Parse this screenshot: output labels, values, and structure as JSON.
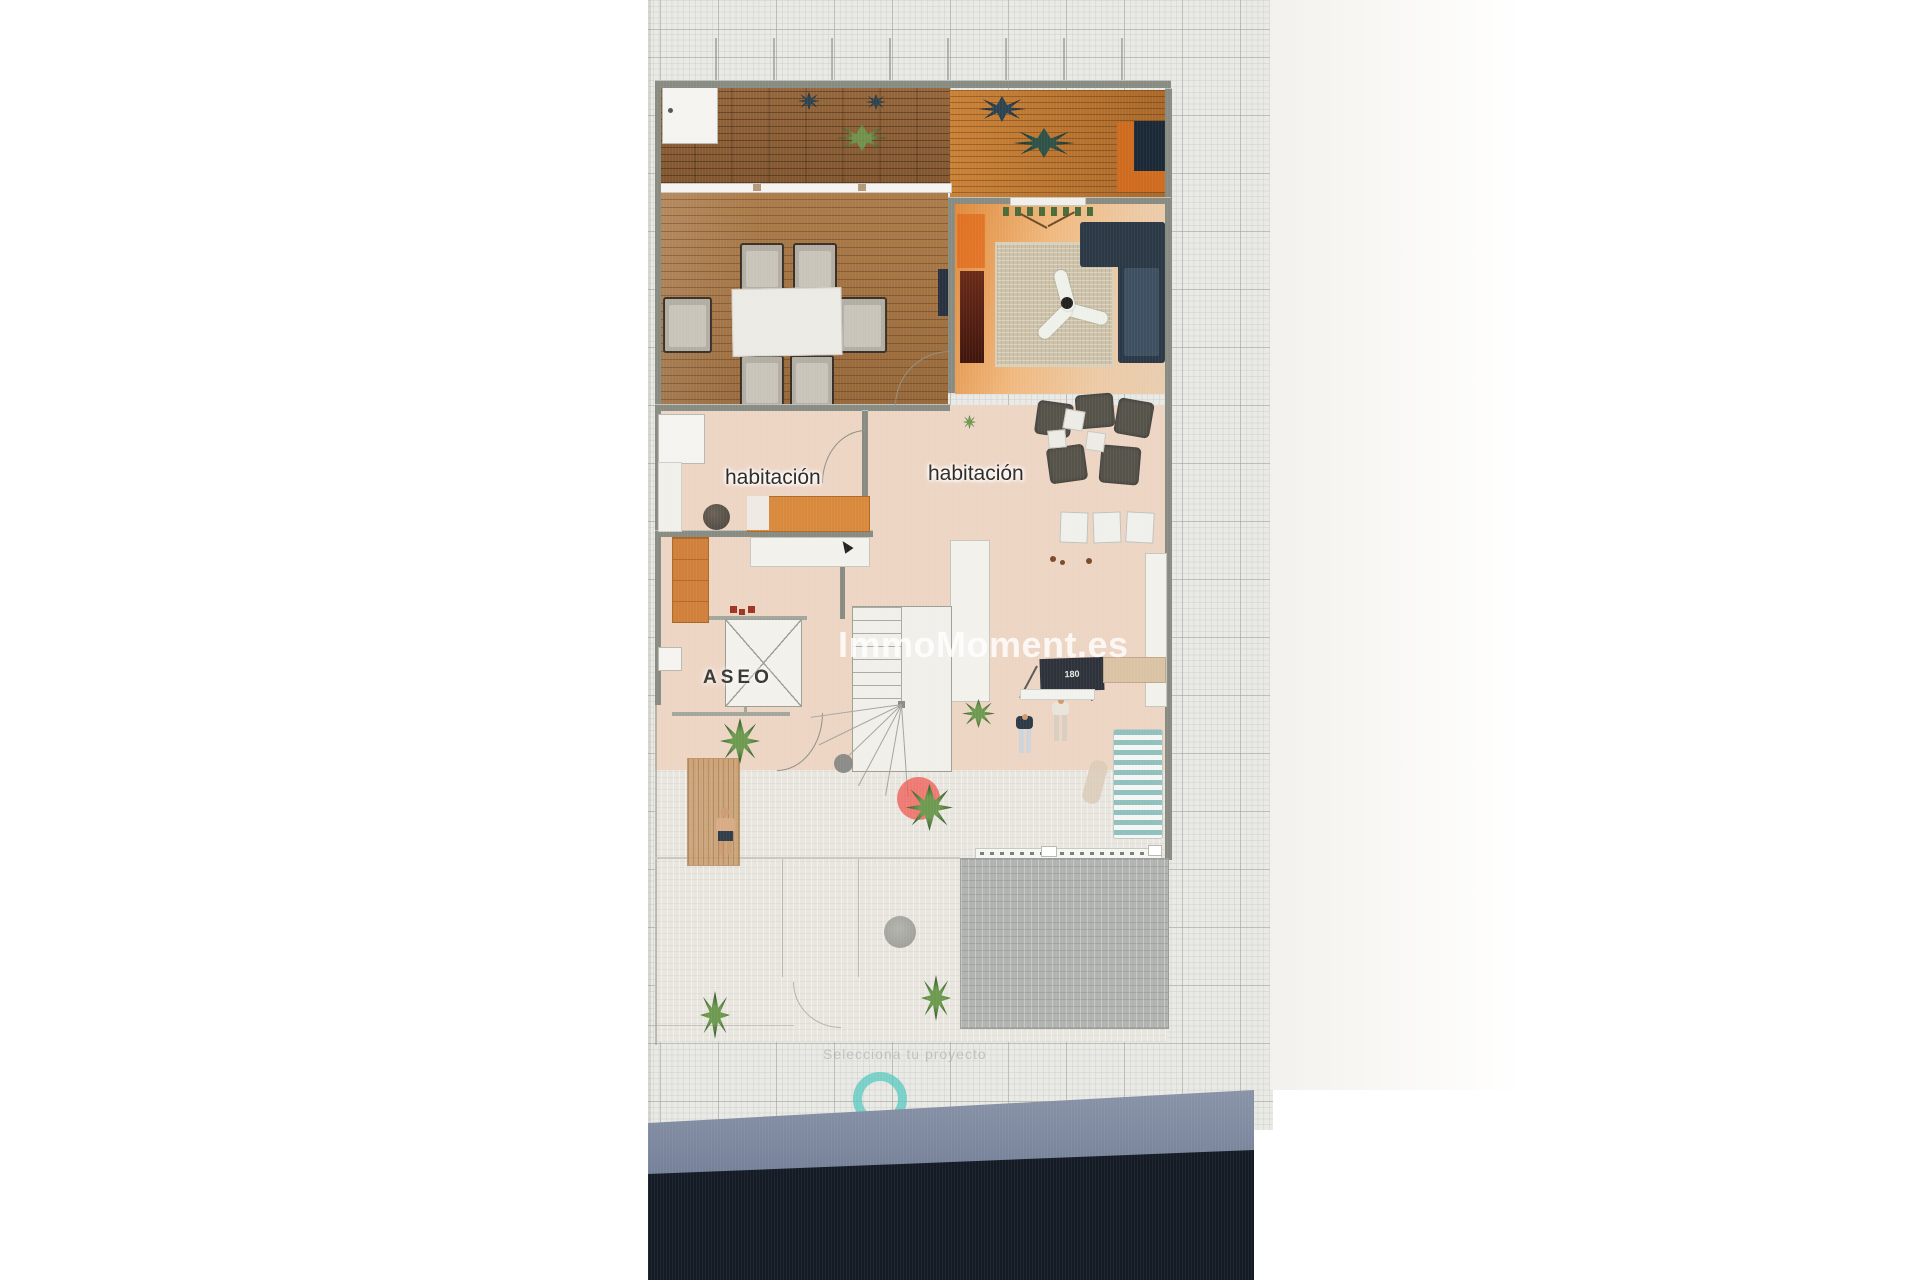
{
  "scene": {
    "description": "photo of a monitor showing a 3D top-down floor plan",
    "watermark": "ImmoMoment.es",
    "caption": "Selecciona tu proyecto"
  },
  "floor_plan": {
    "room_labels": [
      {
        "label": "habitación"
      },
      {
        "label": "habitación"
      }
    ],
    "bathroom_label": "ASEO",
    "sign_text": "180",
    "colors": {
      "wood_deck": "#8a5c33",
      "wood_dining": "#a3713f",
      "living_orange": "#e08a3c",
      "peach_tile": "#edd5c4",
      "terrace_tile": "#e9e6df",
      "paver_gray": "#b1b3b1",
      "sofa_navy": "#2b3845",
      "bed_orange": "#d9893c",
      "red_marker": "#ee5f58",
      "teal_ring": "#50c8be",
      "taskbar_slate": "#6b7790",
      "bezel_navy": "#141b25",
      "grid_paper": "#e9e9e5"
    },
    "icons": [
      "loading-ring-icon",
      "mouse-cursor-icon"
    ]
  }
}
